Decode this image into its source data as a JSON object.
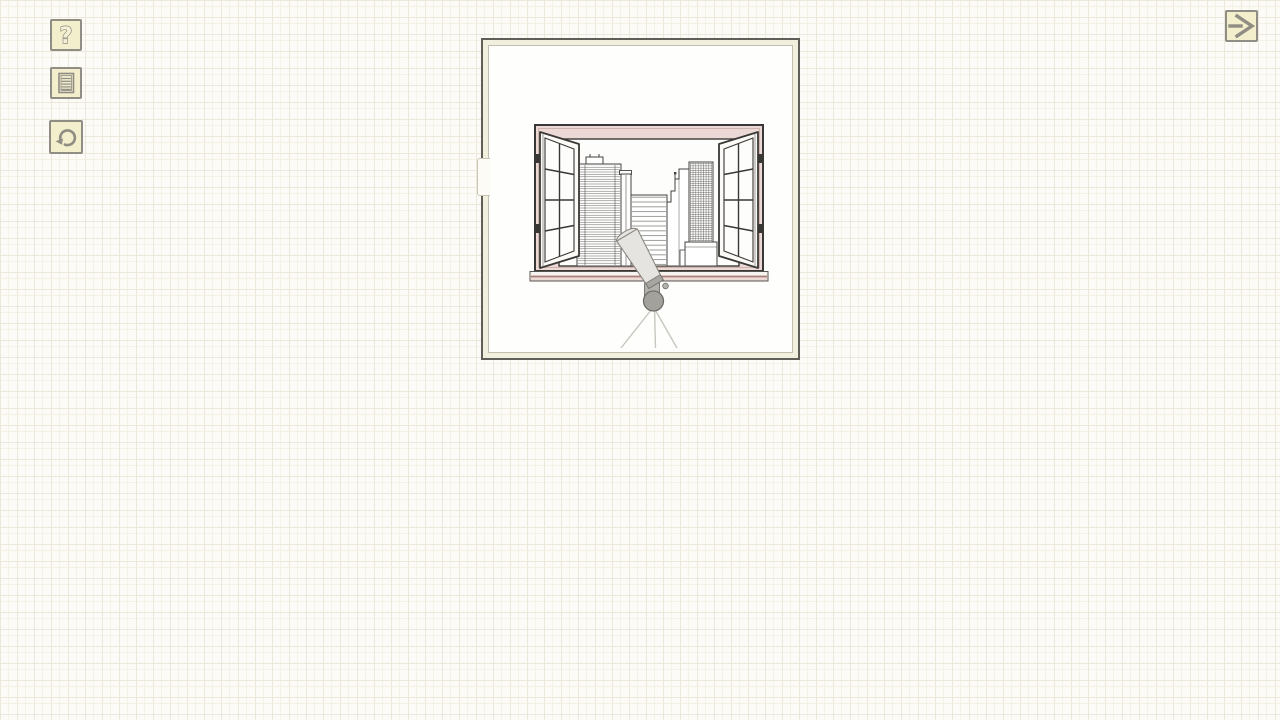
{
  "toolbar": {
    "buttons": [
      {
        "id": "help",
        "icon": "question-mark-icon",
        "glyph": "?"
      },
      {
        "id": "notes",
        "icon": "document-icon"
      },
      {
        "id": "undo",
        "icon": "undo-arrow-icon"
      }
    ]
  },
  "nav": {
    "next": {
      "icon": "arrow-right-icon"
    }
  },
  "scene": {
    "name": "room-with-open-window",
    "elements": [
      "open-casement-window",
      "city-skyline",
      "telescope-on-tripod"
    ]
  },
  "colors": {
    "paper": "#fcfbf7",
    "grid": "#ece8db",
    "btn-bg": "#f3eecb",
    "btn-border": "#8f8d84",
    "icon": "#8f8d84",
    "panel-frame": "#f1efde",
    "panel-outline": "#5f5e57",
    "panel-inner-line": "#c2bfae",
    "scene-bg": "#fefefc",
    "mat": "#ecd9d5",
    "ink": "#3a3835",
    "bline": "#6f6d68",
    "rose": "#a87d74",
    "tube": "#e6e4e0",
    "tube-dark": "#a8a6a1",
    "mount": "#a3a19c",
    "mount-stroke": "#6e6c66",
    "tripod": "#c8c6be"
  }
}
